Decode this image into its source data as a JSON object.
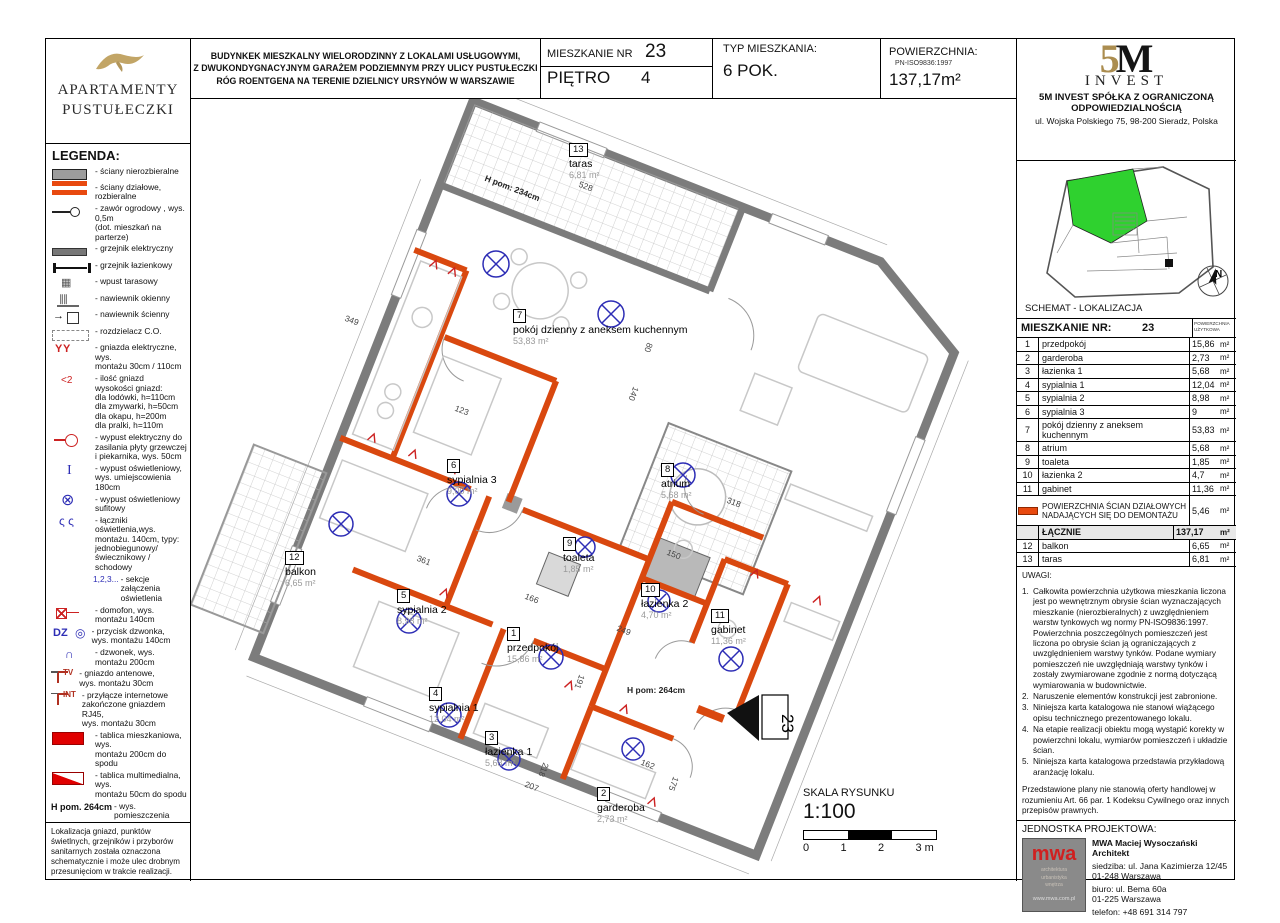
{
  "brand": {
    "line1": "APARTAMENTY",
    "line2": "PUSTUŁECZKI"
  },
  "header": {
    "building_lines": [
      "BUDYNKEK MIESZKALNY WIELORODZINNY Z LOKALAMI USŁUGOWYMI,",
      "Z DWUKONDYGNACYJNYM GARAŻEM PODZIEMNYM PRZY ULICY PUSTUŁECZKI",
      "RÓG ROENTGENA NA TERENIE DZIELNICY URSYNÓW W WARSZAWIE"
    ],
    "apt_label": "MIESZKANIE NR",
    "apt_no": "23",
    "floor_label": "PIĘTRO",
    "floor_no": "4",
    "type_label": "TYP MIESZKANIA:",
    "type_value": "6 POK.",
    "area_label": "POWIERZCHNIA:",
    "area_norm": "PN-ISO9836:1997",
    "area_value": "137,17m²"
  },
  "legend": {
    "title": "LEGENDA:",
    "items": [
      {
        "icon": "wall-gray",
        "text": "- ściany nierozbieralne"
      },
      {
        "icon": "wall-orange",
        "text": "- ściany działowe, rozbieralne"
      },
      {
        "icon": "valve",
        "text": "- zawór ogrodowy , wys. 0,5m\n(dot. mieszkań na parterze)"
      },
      {
        "icon": "heater-electric",
        "text": "- grzejnik elektryczny"
      },
      {
        "icon": "heater-bath",
        "text": "- grzejnik łazienkowy"
      },
      {
        "icon": "drain",
        "text": "- wpust tarasowy"
      },
      {
        "icon": "vent-window",
        "text": "- nawiewnik okienny"
      },
      {
        "icon": "vent-wall",
        "text": "- nawiewnik ścienny"
      },
      {
        "icon": "co-dist",
        "text": "- rozdzielacz C.O."
      },
      {
        "icon": "socket",
        "text": "- gniazda elektryczne, wys.\nmontażu 30cm / 110cm"
      },
      {
        "icon": "socket-count",
        "text": "- ilość gniazd\nwysokości gniazd:\ndla lodówki, h=110cm\ndla zmywarki, h=50cm\ndla okapu,  h=200m\ndla pralki, h=110m"
      },
      {
        "icon": "cooker-outlet",
        "text": "- wypust elektryczny  do\nzasilania płyty grzewczej\ni piekarnika, wys. 50cm"
      },
      {
        "icon": "light-wall",
        "text": "- wypust oświetleniowy,\nwys. umiejscowienia 180cm"
      },
      {
        "icon": "light-ceiling",
        "text": "- wypust oświetleniowy\nsufitowy"
      },
      {
        "icon": "switches",
        "text": "- łączniki oświetlenia,wys.\nmontażu. 140cm, typy:\njednobiegunowy/\nświecznikowy / schodowy"
      },
      {
        "icon": "sections",
        "label": "1,2,3...",
        "text": "- sekcje załączenia\noświetlenia"
      },
      {
        "icon": "intercom",
        "text": "- domofon, wys. montażu 140cm"
      },
      {
        "icon": "doorbell",
        "label": "DZ",
        "text": "- przycisk dzwonka,\nwys. montażu 140cm"
      },
      {
        "icon": "bell",
        "text": "- dzwonek, wys. montażu 200cm"
      },
      {
        "icon": "tv-socket",
        "label": "TV",
        "text": "- gniazdo antenowe,\nwys. montażu 30cm"
      },
      {
        "icon": "internet",
        "label": "INT",
        "text": "- przyłącze internetowe\nzakończone gniazdem RJ45,\nwys. montażu 30cm"
      },
      {
        "icon": "panel-red",
        "text": "- tablica mieszkaniowa, wys.\nmontażu 200cm do spodu"
      },
      {
        "icon": "panel-mm",
        "text": "- tablica multimedialna, wys.\nmontażu 50cm do spodu"
      },
      {
        "icon": "height",
        "label": "H pom. 264cm",
        "text": "- wys.  pomieszczenia"
      },
      {
        "icon": "dashed-outline",
        "text": "- obrys balkonów, nadproży,\nmiejscowych obniżeń"
      }
    ],
    "note": "Lokalizacja gniazd, punktów świetlnych, grzejników i przyborów sanitarnych została oznaczona schematycznie i może ulec drobnym przesunięciom w trakcie realizacji."
  },
  "developer": {
    "logo_5": "5",
    "logo_m": "M",
    "logo_invest": "INVEST",
    "company_line1": "5M INVEST  SPÓŁKA Z OGRANICZONĄ",
    "company_line2": "ODPOWIEDZIALNOŚCIĄ",
    "address": "ul. Wojska Polskiego 75, 98-200 Sieradz, Polska"
  },
  "location": {
    "caption": "SCHEMAT - LOKALIZACJA",
    "compass": "N"
  },
  "rooms_table": {
    "title": "MIESZKANIE NR:",
    "number": "23",
    "col_header": "POWIERZCHNIA\nUŻYTKOWA",
    "rows": [
      {
        "no": "1",
        "name": "przedpokój",
        "area": "15,86",
        "unit": "m²"
      },
      {
        "no": "2",
        "name": "garderoba",
        "area": "2,73",
        "unit": "m²"
      },
      {
        "no": "3",
        "name": "łazienka 1",
        "area": "5,68",
        "unit": "m²"
      },
      {
        "no": "4",
        "name": "sypialnia 1",
        "area": "12,04",
        "unit": "m²"
      },
      {
        "no": "5",
        "name": "sypialnia 2",
        "area": "8,98",
        "unit": "m²"
      },
      {
        "no": "6",
        "name": "sypialnia 3",
        "area": "9",
        "unit": "m²"
      },
      {
        "no": "7",
        "name": "pokój dzienny z aneksem kuchennym",
        "area": "53,83",
        "unit": "m²"
      },
      {
        "no": "8",
        "name": "atrium",
        "area": "5,68",
        "unit": "m²"
      },
      {
        "no": "9",
        "name": "toaleta",
        "area": "1,85",
        "unit": "m²"
      },
      {
        "no": "10",
        "name": "łazienka 2",
        "area": "4,7",
        "unit": "m²"
      },
      {
        "no": "11",
        "name": "gabinet",
        "area": "11,36",
        "unit": "m²"
      }
    ],
    "partition": {
      "name": "POWIERZCHNIA ŚCIAN DZIAŁOWYCH NADAJĄCYCH SIĘ DO DEMONTAŻU",
      "area": "5,46",
      "unit": "m²"
    },
    "total": {
      "label": "ŁĄCZNIE",
      "area": "137,17",
      "unit": "m²"
    },
    "extra_rows": [
      {
        "no": "12",
        "name": "balkon",
        "area": "6,65",
        "unit": "m²"
      },
      {
        "no": "13",
        "name": "taras",
        "area": "6,81",
        "unit": "m²"
      }
    ]
  },
  "uwagi": {
    "title": "UWAGI:",
    "items": [
      {
        "no": "1.",
        "text": "Całkowita powierzchnia użytkowa mieszkania liczona jest po wewnętrznym obrysie ścian wyznaczających mieszkanie (nierozbieralnych) z uwzględnieniem warstw tynkowych wg normy PN-ISO9836:1997. Powierzchnia poszczególnych pomieszczeń jest liczona po obrysie ścian ją ograniczających z uwzględnieniem warstwy tynków. Podane wymiary pomieszczeń nie uwzględniają warstwy tynków i zostały zwymiarowane zgodnie z normą dotyczącą wymiarowania w budownictwie."
      },
      {
        "no": "2.",
        "text": "Naruszenie elementów konstrukcji jest zabronione."
      },
      {
        "no": "3.",
        "text": "Niniejsza karta katalogowa nie stanowi wiążącego opisu technicznego prezentowanego lokalu."
      },
      {
        "no": "4.",
        "text": "Na etapie realizacji obiektu mogą wystąpić korekty w powierzchni lokalu, wymiarów pomieszczeń i układzie ścian."
      },
      {
        "no": "5.",
        "text": "Niniejsza karta katalogowa przedstawia przykładową aranżację lokalu."
      }
    ],
    "footer": "Przedstawione plany nie stanowią oferty handlowej w rozumieniu Art. 66 par. 1 Kodeksu Cywilnego oraz innych przepisów prawnych."
  },
  "design_unit": {
    "title": "JEDNOSTKA PROJEKTOWA:",
    "name": "MWA Maciej Wysoczański Architekt",
    "hq_line1": "siedziba: ul. Jana Kazimierza 12/45",
    "hq_line2": "01-248 Warszawa",
    "office_line1": "biuro: ul. Bema 60a",
    "office_line2": "01-225 Warszawa",
    "phone": "telefon: +48 691 314 797",
    "logo": "mwa",
    "logo_sub": "architektura\nurbanistyka\nwnętrza",
    "logo_web": "www.mwa.com.pl"
  },
  "plan": {
    "entrance": "23",
    "rooms": [
      {
        "no": "13",
        "name": "taras",
        "area": "6,81  m²",
        "x": 378,
        "y": 40
      },
      {
        "no": "7",
        "name": "pokój dzienny z aneksem kuchennym",
        "area": "53,83 m²",
        "x": 322,
        "y": 206
      },
      {
        "no": "6",
        "name": "sypialnia 3",
        "area": "9,00  m²",
        "x": 256,
        "y": 356
      },
      {
        "no": "8",
        "name": "atrium",
        "area": "5,68  m²",
        "x": 470,
        "y": 360
      },
      {
        "no": "12",
        "name": "balkon",
        "area": "6,65  m²",
        "x": 94,
        "y": 448
      },
      {
        "no": "5",
        "name": "sypialnia 2",
        "area": "8,98  m²",
        "x": 206,
        "y": 486
      },
      {
        "no": "1",
        "name": "przedpokój",
        "area": "15,86 m²",
        "x": 316,
        "y": 524
      },
      {
        "no": "9",
        "name": "toaleta",
        "area": "1,85  m²",
        "x": 372,
        "y": 434
      },
      {
        "no": "10",
        "name": "łazienka 2",
        "area": "4,70  m²",
        "x": 450,
        "y": 480
      },
      {
        "no": "11",
        "name": "gabinet",
        "area": "11,36 m²",
        "x": 520,
        "y": 506
      },
      {
        "no": "4",
        "name": "sypialnia 1",
        "area": "12,04 m²",
        "x": 238,
        "y": 584
      },
      {
        "no": "3",
        "name": "łazienka 1",
        "area": "5,68  m²",
        "x": 294,
        "y": 628
      },
      {
        "no": "2",
        "name": "garderoba",
        "area": "2,73  m²",
        "x": 406,
        "y": 684
      }
    ],
    "dims": [
      {
        "v": "528",
        "x": 390,
        "y": 80,
        "r": 21
      },
      {
        "v": "349",
        "x": 156,
        "y": 214,
        "r": 21
      },
      {
        "v": "123",
        "x": 266,
        "y": 304,
        "r": 21
      },
      {
        "v": "80",
        "x": 464,
        "y": 246,
        "r": 111
      },
      {
        "v": "140",
        "x": 450,
        "y": 290,
        "r": 111
      },
      {
        "v": "318",
        "x": 538,
        "y": 396,
        "r": 21
      },
      {
        "v": "361",
        "x": 228,
        "y": 454,
        "r": 21
      },
      {
        "v": "166",
        "x": 336,
        "y": 492,
        "r": 21
      },
      {
        "v": "150",
        "x": 478,
        "y": 448,
        "r": 21
      },
      {
        "v": "249",
        "x": 428,
        "y": 524,
        "r": 21
      },
      {
        "v": "191",
        "x": 396,
        "y": 578,
        "r": 111
      },
      {
        "v": "218",
        "x": 360,
        "y": 666,
        "r": 111
      },
      {
        "v": "207",
        "x": 336,
        "y": 680,
        "r": 21
      },
      {
        "v": "162",
        "x": 452,
        "y": 658,
        "r": 21
      },
      {
        "v": "175",
        "x": 490,
        "y": 680,
        "r": 111
      },
      {
        "v": "H pom: 264cm",
        "x": 436,
        "y": 586,
        "r": 0,
        "cls": "dim-h"
      },
      {
        "v": "H pom: 234cm",
        "x": 296,
        "y": 74,
        "r": 21,
        "cls": "dim-h"
      }
    ],
    "scale": {
      "title": "SKALA RYSUNKU",
      "ratio": "1:100",
      "t0": "0",
      "t1": "1",
      "t2": "2",
      "t3": "3 m"
    }
  }
}
